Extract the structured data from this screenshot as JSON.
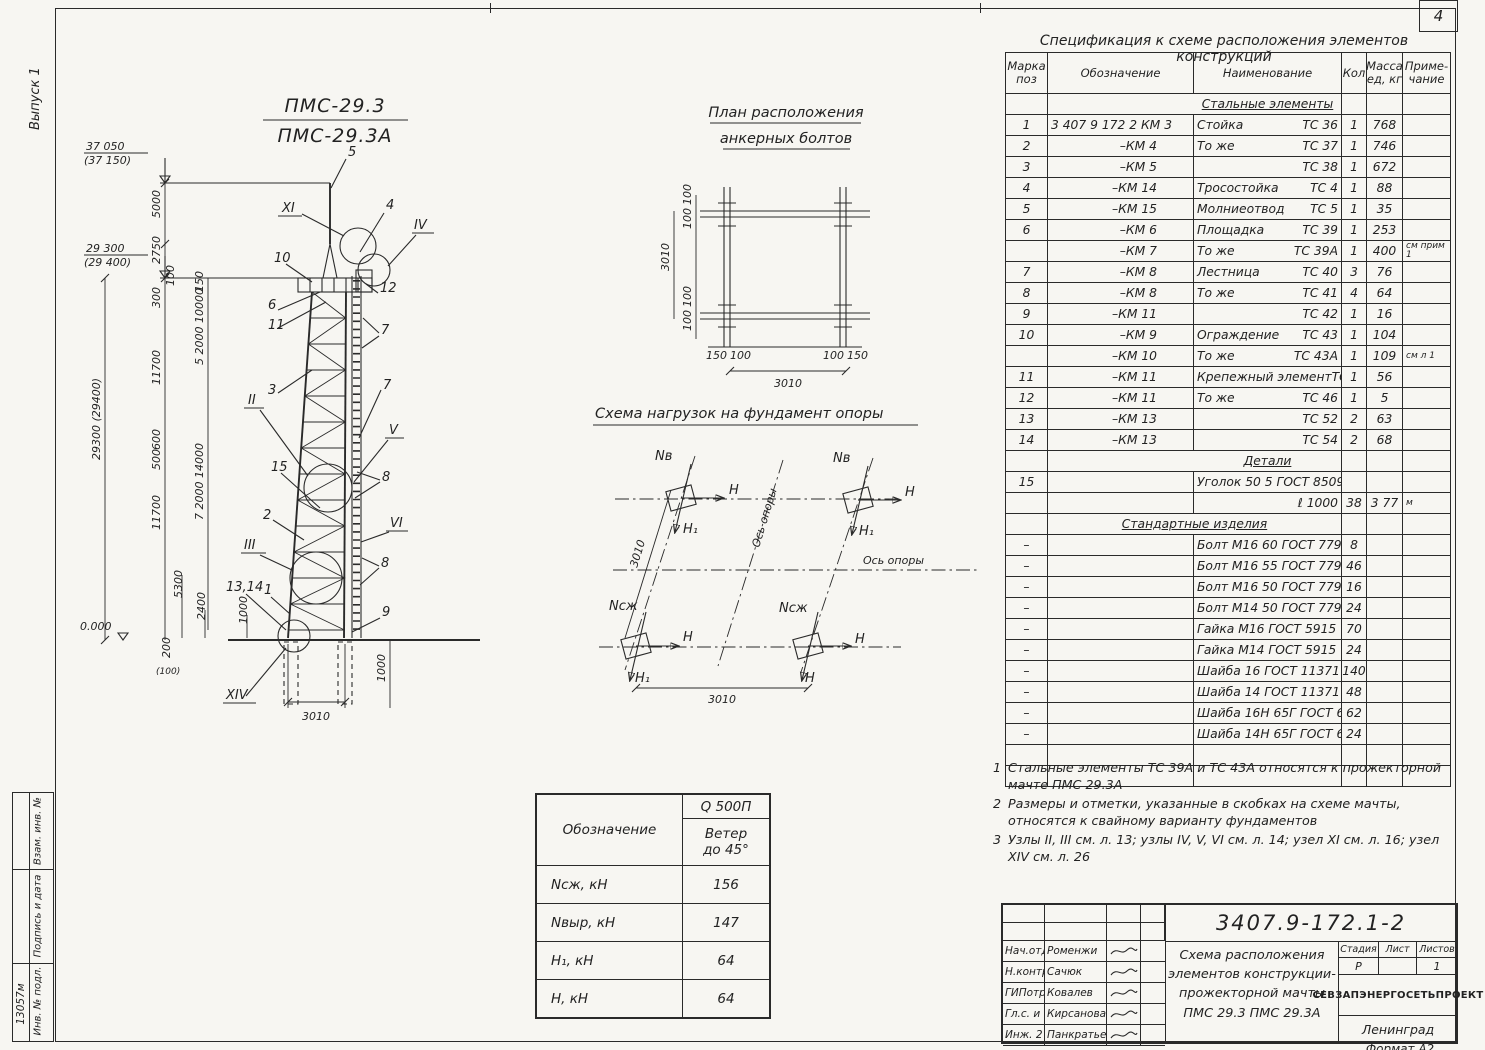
{
  "page": {
    "sheet_number": "4",
    "issue_label": "Выпуск 1",
    "format_note": "Формат А2",
    "strip_top": "Взам. инв. №",
    "strip_mid": "Подпись и дата",
    "strip_bot": "Инв. № подл.",
    "strip_num": "13057м"
  },
  "mast": {
    "title_top": "ПМС-29.3",
    "title_bot": "ПМС-29.3А",
    "elev_top": "37 050",
    "elev_top_b": "(37 150)",
    "elev_mid": "29 300",
    "elev_mid_b": "(29 400)",
    "elev_zero": "0.000",
    "dims": {
      "v5000": "5000",
      "v2750": "2750",
      "vtotal": "29300 (29400)",
      "v100": "100",
      "v300": "300",
      "v150": "150",
      "chain1": "5 2000 10000",
      "v11700a": "11700",
      "v600": "600",
      "v500": "500",
      "chain2": "7 2000 14000",
      "v11700b": "11700",
      "v5300": "5300",
      "v2400": "2400",
      "v1000": "1000",
      "v200": "200",
      "v200b": "(100)",
      "v3010": "3010",
      "v1000r": "1000"
    },
    "callouts": {
      "n1": "1",
      "n2": "2",
      "n3": "3",
      "n4": "4",
      "n5": "5",
      "n6": "6",
      "n7": "7",
      "n8": "8",
      "n9": "9",
      "n10": "10",
      "n11": "11",
      "n12": "12",
      "n15": "15",
      "n1314": "13,14"
    },
    "nodes": {
      "xi": "XI",
      "iv": "IV",
      "ii": "II",
      "v": "V",
      "iii": "III",
      "vi": "VI",
      "xiv": "XIV"
    }
  },
  "anchor": {
    "t1": "План расположения",
    "t2": "анкерных болтов",
    "d3010l": "3010",
    "d3010b": "3010",
    "d100": "100",
    "d150": "150"
  },
  "loads": {
    "title": "Схема нагрузок на фундамент опоры",
    "axis": "Ось опоры",
    "nv": "Nв",
    "nszh": "Nсж",
    "h": "Н",
    "h1": "Н₁",
    "d3010a": "3010",
    "d3010b": "3010"
  },
  "load_table": {
    "c0": "Обозначение",
    "q": "Q 500П",
    "w1": "Ветер",
    "w2": "до 45°",
    "rows": [
      [
        "Nсж, кН",
        "156"
      ],
      [
        "Nвыр, кН",
        "147"
      ],
      [
        "Н₁, кН",
        "64"
      ],
      [
        "Н, кН",
        "64"
      ]
    ]
  },
  "spec": {
    "title": "Спецификация к схеме расположения элементов конструкций",
    "headers": [
      "Марка\nпоз",
      "Обозначение",
      "Наименование",
      "Кол",
      "Масса\nед, кг",
      "Приме-\nчание"
    ],
    "rows": [
      {
        "t": "sec",
        "txt": "Стальные элементы",
        "u": true,
        "span": "name"
      },
      {
        "pos": "1",
        "des": "3 407 9 172 2  КМ 3",
        "nl": "Стойка",
        "nr": "ТС 36",
        "q": "1",
        "m": "768",
        "note": ""
      },
      {
        "pos": "2",
        "des": "–КМ 4",
        "nl": "То же",
        "nr": "ТС 37",
        "q": "1",
        "m": "746",
        "note": ""
      },
      {
        "pos": "3",
        "des": "–КМ 5",
        "nl": "",
        "nr": "ТС 38",
        "q": "1",
        "m": "672",
        "note": ""
      },
      {
        "pos": "4",
        "des": "–КМ 14",
        "nl": "Тросостойка",
        "nr": "ТС 4",
        "q": "1",
        "m": "88",
        "note": ""
      },
      {
        "pos": "5",
        "des": "–КМ 15",
        "nl": "Молниеотвод",
        "nr": "ТС 5",
        "q": "1",
        "m": "35",
        "note": ""
      },
      {
        "pos": "6",
        "des": "–КМ 6",
        "nl": "Площадка",
        "nr": "ТС 39",
        "q": "1",
        "m": "253",
        "note": ""
      },
      {
        "pos": "",
        "des": "–КМ 7",
        "nl": "То же",
        "nr": "ТС 39А",
        "q": "1",
        "m": "400",
        "note": "см прим 1"
      },
      {
        "pos": "7",
        "des": "–КМ 8",
        "nl": "Лестница",
        "nr": "ТС 40",
        "q": "3",
        "m": "76",
        "note": ""
      },
      {
        "pos": "8",
        "des": "–КМ 8",
        "nl": "То же",
        "nr": "ТС 41",
        "q": "4",
        "m": "64",
        "note": ""
      },
      {
        "pos": "9",
        "des": "–КМ 11",
        "nl": "",
        "nr": "ТС 42",
        "q": "1",
        "m": "16",
        "note": ""
      },
      {
        "pos": "10",
        "des": "–КМ 9",
        "nl": "Ограждение",
        "nr": "ТС 43",
        "q": "1",
        "m": "104",
        "note": ""
      },
      {
        "pos": "",
        "des": "–КМ 10",
        "nl": "То же",
        "nr": "ТС 43А",
        "q": "1",
        "m": "109",
        "note": "см л 1"
      },
      {
        "pos": "11",
        "des": "–КМ 11",
        "nl": "Крепежный элемент",
        "nr": "ТС 44",
        "q": "1",
        "m": "56",
        "note": ""
      },
      {
        "pos": "12",
        "des": "–КМ 11",
        "nl": "То же",
        "nr": "ТС 46",
        "q": "1",
        "m": "5",
        "note": ""
      },
      {
        "pos": "13",
        "des": "–КМ 13",
        "nl": "",
        "nr": "ТС 52",
        "q": "2",
        "m": "63",
        "note": ""
      },
      {
        "pos": "14",
        "des": "–КМ 13",
        "nl": "",
        "nr": "ТС 54",
        "q": "2",
        "m": "68",
        "note": ""
      },
      {
        "t": "sec",
        "txt": "Детали",
        "u": true,
        "span": "name"
      },
      {
        "pos": "15",
        "des": "",
        "nl": "Уголок 50 5 ГОСТ 8509 86",
        "nr": "",
        "q": "",
        "m": "",
        "note": ""
      },
      {
        "pos": "",
        "des": "",
        "nl": "",
        "nr": "ℓ 1000",
        "q": "38",
        "m": "3 77",
        "note": "м"
      },
      {
        "t": "sec",
        "txt": "Стандартные изделия",
        "u": true,
        "span": "wide"
      },
      {
        "pos": "–",
        "des": "",
        "nl": "Болт М16 60 ГОСТ 7798 70*",
        "nr": "",
        "q": "8",
        "m": "",
        "note": ""
      },
      {
        "pos": "–",
        "des": "",
        "nl": "Болт М16 55 ГОСТ 7798 70*",
        "nr": "",
        "q": "46",
        "m": "",
        "note": ""
      },
      {
        "pos": "–",
        "des": "",
        "nl": "Болт М16 50 ГОСТ 7798 70*",
        "nr": "",
        "q": "16",
        "m": "",
        "note": ""
      },
      {
        "pos": "–",
        "des": "",
        "nl": "Болт М14 50 ГОСТ 7798 70*",
        "nr": "",
        "q": "24",
        "m": "",
        "note": ""
      },
      {
        "pos": "–",
        "des": "",
        "nl": "Гайка М16 ГОСТ 5915 70*",
        "nr": "",
        "q": "70",
        "m": "",
        "note": ""
      },
      {
        "pos": "–",
        "des": "",
        "nl": "Гайка М14 ГОСТ 5915 70*",
        "nr": "",
        "q": "24",
        "m": "",
        "note": ""
      },
      {
        "pos": "–",
        "des": "",
        "nl": "Шайба 16 ГОСТ 11371 78*",
        "nr": "",
        "q": "140",
        "m": "",
        "note": ""
      },
      {
        "pos": "–",
        "des": "",
        "nl": "Шайба 14 ГОСТ 11371 78*",
        "nr": "",
        "q": "48",
        "m": "",
        "note": ""
      },
      {
        "pos": "–",
        "des": "",
        "nl": "Шайба 16Н 65Г ГОСТ 6402 70",
        "nr": "",
        "q": "62",
        "m": "",
        "note": ""
      },
      {
        "pos": "–",
        "des": "",
        "nl": "Шайба 14Н 65Г ГОСТ 6402 70*",
        "nr": "",
        "q": "24",
        "m": "",
        "note": ""
      },
      {
        "t": "empty"
      },
      {
        "t": "empty"
      }
    ]
  },
  "notes": [
    {
      "n": "1",
      "t": "Стальные элементы ТС 39А и ТС 43А относятся к прожекторной мачте ПМС 29.3А"
    },
    {
      "n": "2",
      "t": "Размеры и отметки, указанные в скобках на схеме мачты, относятся к свайному варианту фундаментов"
    },
    {
      "n": "3",
      "t": "Узлы II, III см. л. 13; узлы IV, V, VI см. л. 14; узел XI см. л. 16; узел XIV см. л. 26"
    }
  ],
  "tb": {
    "number": "3407.9-172.1-2",
    "t1": "Схема расположения",
    "t2": "элементов конструкции-",
    "t3": "прожекторной мачты",
    "t4": "ПМС 29.3  ПМС 29.3А",
    "stage_l": "Стадия",
    "sheet_l": "Лист",
    "sheets_l": "Листов",
    "stage": "Р",
    "sheet": "",
    "sheets": "1",
    "org": "СЕВЗАПЭНЕРГОСЕТЬПРОЕКТ",
    "city": "Ленинград",
    "roles": [
      {
        "r": "Нач.отд",
        "n": "Роменжи"
      },
      {
        "r": "Н.контр",
        "n": "Сачюк"
      },
      {
        "r": "ГИПотр",
        "n": "Ковалев"
      },
      {
        "r": "Гл.с. и",
        "n": "Кирсанова"
      },
      {
        "r": "Инж. 2",
        "n": "Панкратьева"
      }
    ]
  }
}
